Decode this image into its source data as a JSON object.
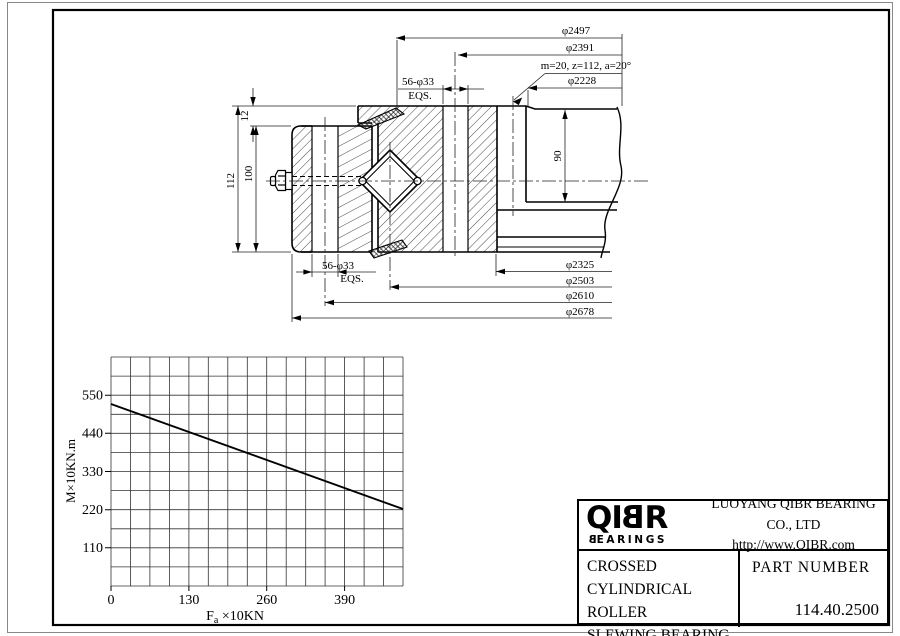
{
  "drawing": {
    "top_dims": {
      "d2497": "φ2497",
      "d2391": "φ2391",
      "d2228": "φ2228"
    },
    "gear_spec": "m=20, z=112, a=20°",
    "bolt_top": {
      "line1": "56-φ33",
      "line2": "EQS."
    },
    "bolt_bottom": {
      "line1": "56-φ33",
      "line2": "EQS."
    },
    "height_total": "112",
    "height_inner": "100",
    "height_offset": "12",
    "gear_width": "90",
    "bottom_dims": {
      "d2325": "φ2325",
      "d2503": "φ2503",
      "d2610": "φ2610",
      "d2678": "φ2678"
    }
  },
  "chart_data": {
    "type": "line",
    "title": "",
    "xlabel_main": "F",
    "xlabel_sub": "a",
    "xlabel_rest": " ×10KN",
    "ylabel": "M×10KN.m",
    "x_ticks": [
      0,
      130,
      260,
      390
    ],
    "y_ticks": [
      110,
      220,
      330,
      440,
      550
    ],
    "x_tick_labels": [
      "0",
      "130",
      "260",
      "390"
    ],
    "y_tick_labels": [
      "550",
      "440",
      "330",
      "220",
      "110"
    ],
    "x_range": [
      0,
      487
    ],
    "y_range": [
      0,
      660
    ],
    "grid": true,
    "legend": "none",
    "series": [
      {
        "name": "tilting moment vs axial load",
        "points": [
          [
            0,
            525
          ],
          [
            487,
            222
          ]
        ]
      }
    ]
  },
  "title_block": {
    "logo_pre": "QI",
    "logo_b": "B",
    "logo_post": "R",
    "logo_sub_b": "B",
    "logo_sub_rest": "EARINGS",
    "company": "LUOYANG QIBR BEARING CO., LTD",
    "url": "http://www.QIBR.com",
    "product_line1": "CROSSED",
    "product_line2": "CYLINDRICAL ROLLER",
    "product_line3": "SLEWING BEARING",
    "part_label": "PART NUMBER",
    "part_number": "114.40.2500"
  }
}
